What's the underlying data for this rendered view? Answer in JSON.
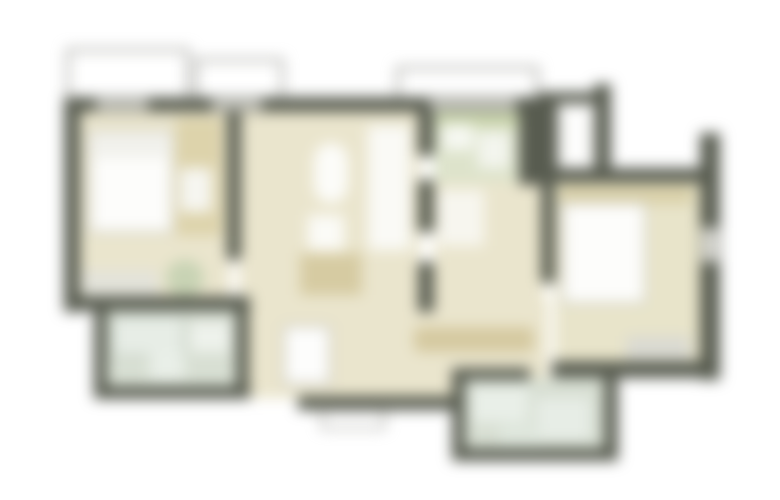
{
  "plan": {
    "canvas": {
      "width": 780,
      "height": 500,
      "background": "#ffffff"
    },
    "blur_px": 7,
    "palette": {
      "wall": "#585c50",
      "floor_beige": "#eae5cd",
      "floor_bath_green": "#d8dfd3",
      "floor_kitchen_green": "#dde3cb",
      "furniture_tan": "#d8cda4",
      "furniture_white": "#fcfcf9",
      "rug_gray": "#dadad2",
      "outline_gray": "#9a9a94",
      "window_gray": "#c6c6bf"
    },
    "shapes": [
      {
        "name": "balcony-left-outline",
        "x": 68,
        "y": 50,
        "w": 120,
        "h": 50,
        "fill": "#ffffff",
        "stroke": "#9a9a94",
        "sw": 3
      },
      {
        "name": "balcony-left2-outline",
        "x": 196,
        "y": 60,
        "w": 86,
        "h": 40,
        "fill": "#ffffff",
        "stroke": "#9a9a94",
        "sw": 3
      },
      {
        "name": "balcony-top-right-outline",
        "x": 398,
        "y": 68,
        "w": 139,
        "h": 34,
        "fill": "#ffffff",
        "stroke": "#9a9a94",
        "sw": 3
      },
      {
        "name": "bedroom-left-floor",
        "x": 78,
        "y": 110,
        "w": 152,
        "h": 190,
        "fill": "#eae5cd"
      },
      {
        "name": "living-room-floor",
        "x": 239,
        "y": 110,
        "w": 181,
        "h": 200,
        "fill": "#eae5cd"
      },
      {
        "name": "hallway-floor",
        "x": 248,
        "y": 300,
        "w": 300,
        "h": 98,
        "fill": "#eae5cd"
      },
      {
        "name": "corridor-floor",
        "x": 434,
        "y": 180,
        "w": 110,
        "h": 130,
        "fill": "#eae5cd"
      },
      {
        "name": "kitchen-floor",
        "x": 434,
        "y": 110,
        "w": 87,
        "h": 72,
        "fill": "#dde3cb"
      },
      {
        "name": "bedroom-right-floor",
        "x": 555,
        "y": 183,
        "w": 148,
        "h": 182,
        "fill": "#e8e4ca"
      },
      {
        "name": "bath-left-floor",
        "x": 106,
        "y": 310,
        "w": 131,
        "h": 78,
        "fill": "#d8dfd3"
      },
      {
        "name": "bath-bottom-floor",
        "x": 464,
        "y": 378,
        "w": 142,
        "h": 74,
        "fill": "#d8dfd3"
      },
      {
        "name": "bed-left",
        "x": 90,
        "y": 132,
        "w": 82,
        "h": 100,
        "fill": "#fdfdfb",
        "stroke": "#c4c4bc",
        "sw": 2
      },
      {
        "name": "bed-left-pillow",
        "x": 94,
        "y": 136,
        "w": 74,
        "h": 22,
        "fill": "#f1f1ec"
      },
      {
        "name": "desk-left",
        "x": 176,
        "y": 118,
        "w": 46,
        "h": 118,
        "fill": "#ddd3ab"
      },
      {
        "name": "chair-left",
        "x": 180,
        "y": 168,
        "w": 32,
        "h": 44,
        "fill": "#f6f6f1"
      },
      {
        "name": "rug-left",
        "x": 82,
        "y": 270,
        "w": 76,
        "h": 28,
        "fill": "#e3e3da"
      },
      {
        "name": "plant-left",
        "x": 166,
        "y": 260,
        "w": 38,
        "h": 36,
        "fill": "#c8d3b4",
        "rx": 18
      },
      {
        "name": "living-white-unit",
        "x": 368,
        "y": 126,
        "w": 42,
        "h": 124,
        "fill": "#fafaf6"
      },
      {
        "name": "living-oval-table",
        "x": 314,
        "y": 143,
        "w": 34,
        "h": 60,
        "fill": "#fcfcf9",
        "rx": 17
      },
      {
        "name": "living-chair",
        "x": 308,
        "y": 215,
        "w": 36,
        "h": 36,
        "fill": "#fbfbf7"
      },
      {
        "name": "living-sofa",
        "x": 300,
        "y": 253,
        "w": 62,
        "h": 42,
        "fill": "#d6cba2"
      },
      {
        "name": "kitchen-counter",
        "x": 437,
        "y": 110,
        "w": 84,
        "h": 16,
        "fill": "#c9d4ab"
      },
      {
        "name": "kitchen-sink",
        "x": 443,
        "y": 124,
        "w": 30,
        "h": 26,
        "fill": "#f6f8f2"
      },
      {
        "name": "kitchen-stove",
        "x": 478,
        "y": 132,
        "w": 32,
        "h": 36,
        "fill": "#f3f5ee"
      },
      {
        "name": "corridor-door-swing",
        "x": 438,
        "y": 190,
        "w": 46,
        "h": 56,
        "fill": "#f7f6ef"
      },
      {
        "name": "hall-washer",
        "x": 284,
        "y": 326,
        "w": 46,
        "h": 58,
        "fill": "#fdfdfc",
        "stroke": "#b5b5ad",
        "sw": 2
      },
      {
        "name": "hall-wardrobe",
        "x": 414,
        "y": 327,
        "w": 120,
        "h": 25,
        "fill": "#d5c9a0",
        "rx": 6
      },
      {
        "name": "bedroom-right-desk",
        "x": 560,
        "y": 186,
        "w": 132,
        "h": 18,
        "fill": "#d9d0a8"
      },
      {
        "name": "bed-right",
        "x": 563,
        "y": 203,
        "w": 82,
        "h": 100,
        "fill": "#fdfdfb",
        "stroke": "#c4c4bc",
        "sw": 2
      },
      {
        "name": "bedroom-right-rug",
        "x": 626,
        "y": 336,
        "w": 64,
        "h": 24,
        "fill": "#dadad2"
      },
      {
        "name": "bath-left-tub",
        "x": 112,
        "y": 316,
        "w": 72,
        "h": 40,
        "fill": "#e7ede6",
        "stroke": "#b9c4b7",
        "sw": 2
      },
      {
        "name": "bath-left-sink",
        "x": 190,
        "y": 322,
        "w": 40,
        "h": 30,
        "fill": "#eef2ec"
      },
      {
        "name": "bath-left-toilet",
        "x": 150,
        "y": 352,
        "w": 34,
        "h": 28,
        "fill": "#e9efe8"
      },
      {
        "name": "bath-bottom-shower",
        "x": 472,
        "y": 386,
        "w": 56,
        "h": 36,
        "fill": "#e9efe8"
      },
      {
        "name": "bath-bottom-tub",
        "x": 536,
        "y": 398,
        "w": 54,
        "h": 42,
        "fill": "#e7ede6"
      },
      {
        "name": "bath-bottom-sink",
        "x": 500,
        "y": 424,
        "w": 40,
        "h": 22,
        "fill": "#dfe7dd"
      },
      {
        "name": "wall-top-main",
        "x": 64,
        "y": 97,
        "w": 484,
        "h": 15,
        "fill": "#585c50"
      },
      {
        "name": "wall-left",
        "x": 64,
        "y": 97,
        "w": 16,
        "h": 215,
        "fill": "#585c50"
      },
      {
        "name": "wall-bedroom1-living",
        "x": 227,
        "y": 110,
        "w": 14,
        "h": 150,
        "fill": "#585c50"
      },
      {
        "name": "wall-bottom-left",
        "x": 64,
        "y": 296,
        "w": 186,
        "h": 15,
        "fill": "#585c50"
      },
      {
        "name": "bath-left-wall-left",
        "x": 94,
        "y": 300,
        "w": 13,
        "h": 98,
        "fill": "#585c50"
      },
      {
        "name": "bath-left-wall-bottom",
        "x": 94,
        "y": 386,
        "w": 156,
        "h": 13,
        "fill": "#585c50"
      },
      {
        "name": "bath-left-wall-right",
        "x": 236,
        "y": 300,
        "w": 13,
        "h": 92,
        "fill": "#585c50"
      },
      {
        "name": "hall-bottom-wall",
        "x": 298,
        "y": 396,
        "w": 156,
        "h": 14,
        "fill": "#585c50"
      },
      {
        "name": "entry-step-outline",
        "x": 322,
        "y": 410,
        "w": 62,
        "h": 18,
        "fill": "#ffffff",
        "stroke": "#8b8b84",
        "sw": 2
      },
      {
        "name": "wall-corridor-left-a",
        "x": 418,
        "y": 110,
        "w": 16,
        "h": 46,
        "fill": "#585c50"
      },
      {
        "name": "wall-corridor-left-b",
        "x": 418,
        "y": 180,
        "w": 16,
        "h": 52,
        "fill": "#585c50"
      },
      {
        "name": "wall-corridor-left-c",
        "x": 418,
        "y": 262,
        "w": 16,
        "h": 50,
        "fill": "#585c50"
      },
      {
        "name": "wall-kitchen-right",
        "x": 519,
        "y": 97,
        "w": 28,
        "h": 88,
        "fill": "#585c50"
      },
      {
        "name": "wall-stub-top-a",
        "x": 538,
        "y": 92,
        "w": 20,
        "h": 80,
        "fill": "#585c50"
      },
      {
        "name": "wall-stub-top-bar",
        "x": 538,
        "y": 92,
        "w": 72,
        "h": 13,
        "fill": "#585c50"
      },
      {
        "name": "wall-stub-top-b",
        "x": 594,
        "y": 84,
        "w": 17,
        "h": 88,
        "fill": "#585c50"
      },
      {
        "name": "window-right-top",
        "x": 558,
        "y": 104,
        "w": 36,
        "h": 66,
        "fill": "#fdfdfc",
        "stroke": "#b0b0a8",
        "sw": 2
      },
      {
        "name": "wall-bedroom2-top",
        "x": 538,
        "y": 168,
        "w": 168,
        "h": 15,
        "fill": "#585c50"
      },
      {
        "name": "wall-bedroom2-left",
        "x": 541,
        "y": 183,
        "w": 14,
        "h": 100,
        "fill": "#585c50"
      },
      {
        "name": "wall-right",
        "x": 700,
        "y": 133,
        "w": 20,
        "h": 247,
        "fill": "#585c50"
      },
      {
        "name": "wall-bedroom2-bottom",
        "x": 552,
        "y": 361,
        "w": 168,
        "h": 17,
        "fill": "#585c50"
      },
      {
        "name": "bath-bottom-wall-left",
        "x": 452,
        "y": 368,
        "w": 13,
        "h": 92,
        "fill": "#585c50"
      },
      {
        "name": "bath-bottom-wall-bottom",
        "x": 452,
        "y": 448,
        "w": 166,
        "h": 13,
        "fill": "#585c50"
      },
      {
        "name": "bath-bottom-wall-right",
        "x": 604,
        "y": 368,
        "w": 14,
        "h": 92,
        "fill": "#585c50"
      },
      {
        "name": "bath-bottom-wall-top",
        "x": 452,
        "y": 368,
        "w": 78,
        "h": 12,
        "fill": "#585c50"
      },
      {
        "name": "window-bedroom-left",
        "x": 96,
        "y": 99,
        "w": 52,
        "h": 11,
        "fill": "#c6c6bf"
      },
      {
        "name": "window-living",
        "x": 212,
        "y": 99,
        "w": 50,
        "h": 11,
        "fill": "#c6c6bf"
      },
      {
        "name": "window-kitchen",
        "x": 430,
        "y": 99,
        "w": 86,
        "h": 11,
        "fill": "#c6c6bf"
      },
      {
        "name": "window-right-wall",
        "x": 702,
        "y": 228,
        "w": 16,
        "h": 34,
        "fill": "#d8d8d2"
      }
    ]
  }
}
